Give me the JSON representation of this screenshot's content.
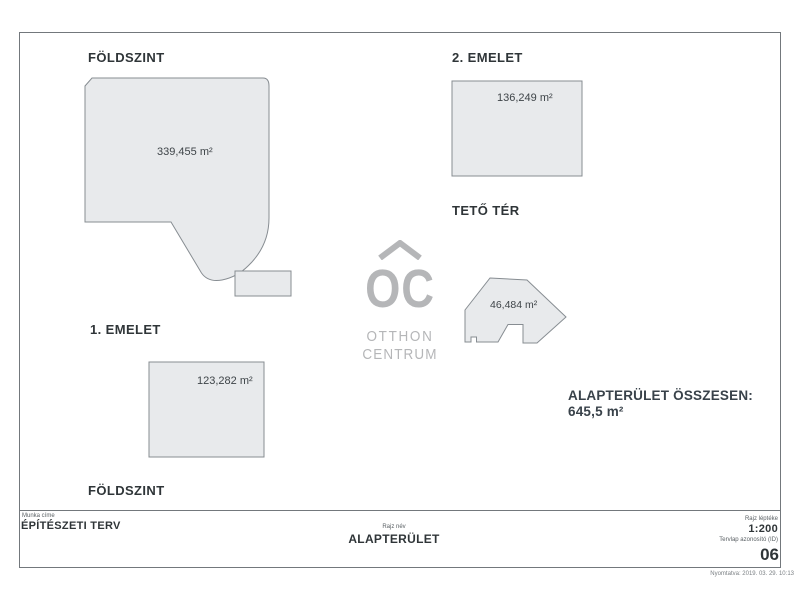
{
  "document": {
    "type": "architectural-area-plan-scan",
    "colors": {
      "shape_fill": "#e8eaec",
      "shape_stroke": "#878d92",
      "text": "#2f3538",
      "watermark": "#b5b6b8",
      "border": "#73787c"
    },
    "sections": {
      "ground": {
        "label": "FÖLDSZINT",
        "area": "339,455 m²"
      },
      "second": {
        "label": "2. EMELET",
        "area": "136,249 m²"
      },
      "first": {
        "label": "1. EMELET",
        "area": "123,282 m²"
      },
      "roof": {
        "label": "TETŐ TÉR",
        "area": "46,484 m²"
      },
      "ground_repeat_label": "FÖLDSZINT"
    },
    "summary": {
      "title": "ALAPTERÜLET ÖSSZESEN:",
      "value": "645,5 m²"
    },
    "watermark": {
      "icon": "roof-chevron",
      "initials": "OC",
      "word1": "OTTHON",
      "word2": "CENTRUM"
    },
    "title_block": {
      "work_title_label": "Munka címe",
      "work_title": "ÉPÍTÉSZETI TERV",
      "drawing_name_label": "Rajz név",
      "drawing_name": "ALAPTERÜLET",
      "scale_label": "Rajz léptéke",
      "scale": "1:200",
      "sheet_id_label": "Tervlap azonosító (ID)",
      "sheet_id": "06",
      "printed": "Nyomtatva: 2019. 03. 29. 10:13"
    }
  }
}
